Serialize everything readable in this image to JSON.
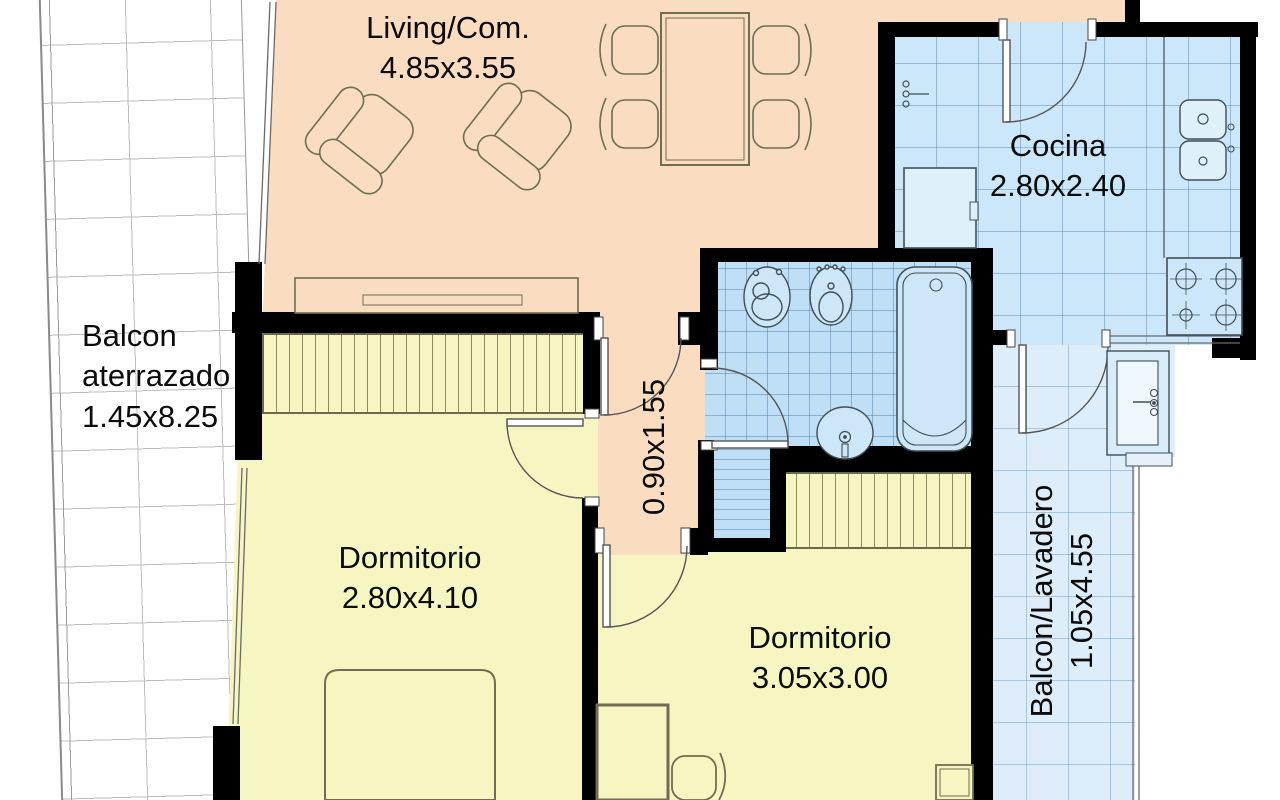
{
  "plan_title": "Apartment floor plan",
  "rooms": {
    "living": {
      "label": "Living/Com.",
      "dims": "4.85x3.55"
    },
    "cocina": {
      "label": "Cocina",
      "dims": "2.80x2.40"
    },
    "balcon_aterrazado": {
      "label": "Balcon aterrazado",
      "dims": "1.45x8.25"
    },
    "pasillo": {
      "dims": "0.90x1.55"
    },
    "dormitorio_1": {
      "label": "Dormitorio",
      "dims": "2.80x4.10"
    },
    "dormitorio_2": {
      "label": "Dormitorio",
      "dims": "3.05x3.00"
    },
    "balcon_lavadero": {
      "label": "Balcon/Lavadero",
      "dims": "1.05x4.55"
    }
  },
  "items": [
    "armchair",
    "armchair",
    "dining-table",
    "dining-chair",
    "dining-chair",
    "dining-chair",
    "dining-chair",
    "sideboard",
    "double-bed",
    "wardrobe",
    "wardrobe",
    "desk",
    "desk-chair",
    "nightstand",
    "toilet",
    "bidet",
    "bathtub",
    "washbasin",
    "kitchen-sink",
    "stove",
    "refrigerator",
    "water-heater",
    "laundry-tub"
  ],
  "colors": {
    "living": "#fadcc1",
    "bedroom": "#f6f6c3",
    "bathroom": "#bfdff7",
    "kitchen": "#cce7fa",
    "balcony_right": "#ddeefa",
    "balcony_left": "#ffffff",
    "wall": "#000000",
    "furniture_outline": "#6e6e50",
    "fixture_outline": "#3f4f58",
    "text": "#0c0c0c"
  }
}
